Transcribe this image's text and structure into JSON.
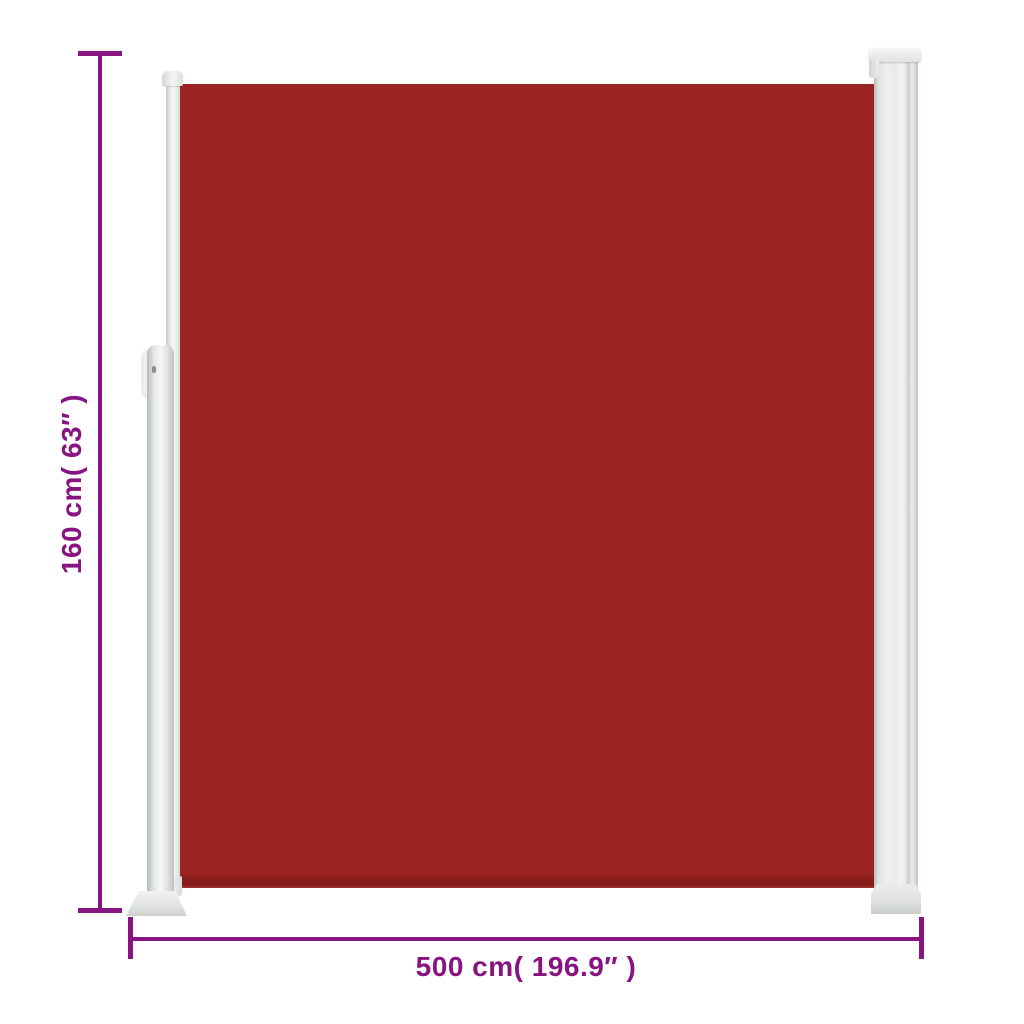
{
  "diagram": {
    "type": "product-dimension-diagram",
    "product": "retractable-side-awning",
    "labels": {
      "height": "160 cm( 63″ )",
      "width": "500 cm( 196.9″ )"
    },
    "dimensions": {
      "height_cm": 160,
      "height_in": 63,
      "width_cm": 500,
      "width_in": 196.9
    },
    "parts": {
      "fabric_screen": "red awning fabric panel",
      "cassette": "roller cassette column (right)",
      "front_bar": "front profile pull bar (left)",
      "support_post": "ground support post with handle and base plate"
    },
    "colors": {
      "background": "#ffffff",
      "fabric": "#9b2422",
      "dimension": "#871480",
      "frame_light": "#f2f4f2",
      "frame_shadow": "#b9beb9"
    }
  }
}
